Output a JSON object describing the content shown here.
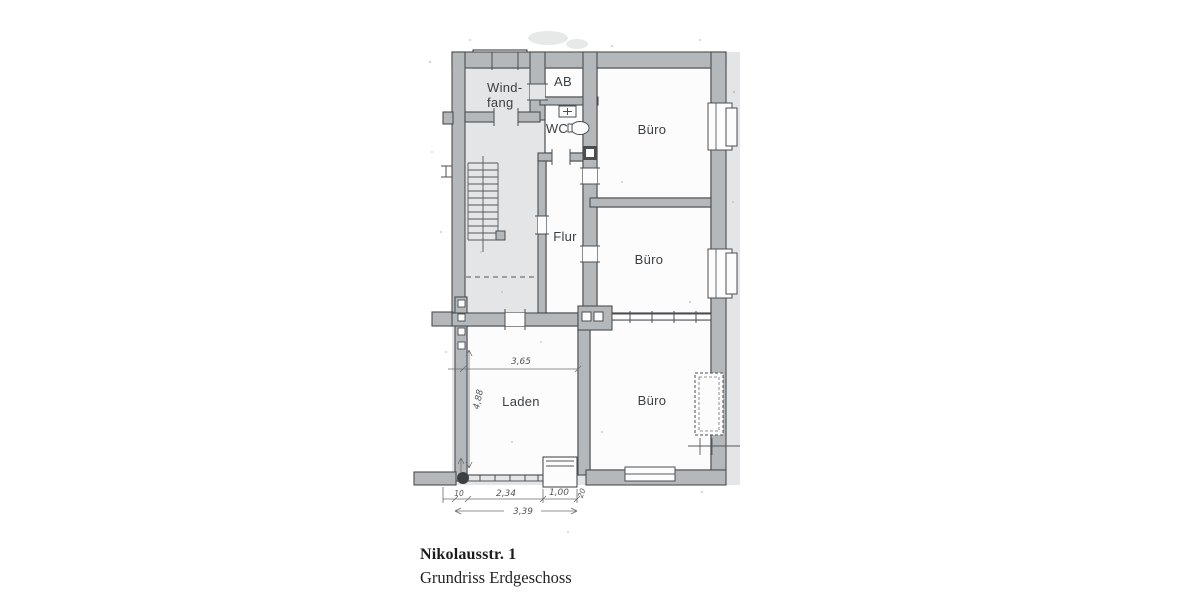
{
  "plan": {
    "rooms": {
      "windfang_line1": "Wind-",
      "windfang_line2": "fang",
      "ab": "AB",
      "wc": "WC",
      "buero_top": "Büro",
      "flur": "Flur",
      "buero_mid": "Büro",
      "laden": "Laden",
      "buero_bottom": "Büro"
    },
    "dimensions": {
      "laden_width": "3,65",
      "laden_depth": "4,88",
      "pier_left": "10",
      "shop_window": "2,34",
      "entry_width": "1,00",
      "pier_right": "20",
      "front_total": "3,39"
    },
    "colors": {
      "wall_fill": "#b4b8ba",
      "wall_outline": "#4a4e51",
      "floor_tint": "#e3e5e6",
      "room_fill": "#fcfcfd"
    }
  },
  "caption": {
    "title": "Nikolausstr. 1",
    "subtitle": "Grundriss Erdgeschoss"
  }
}
